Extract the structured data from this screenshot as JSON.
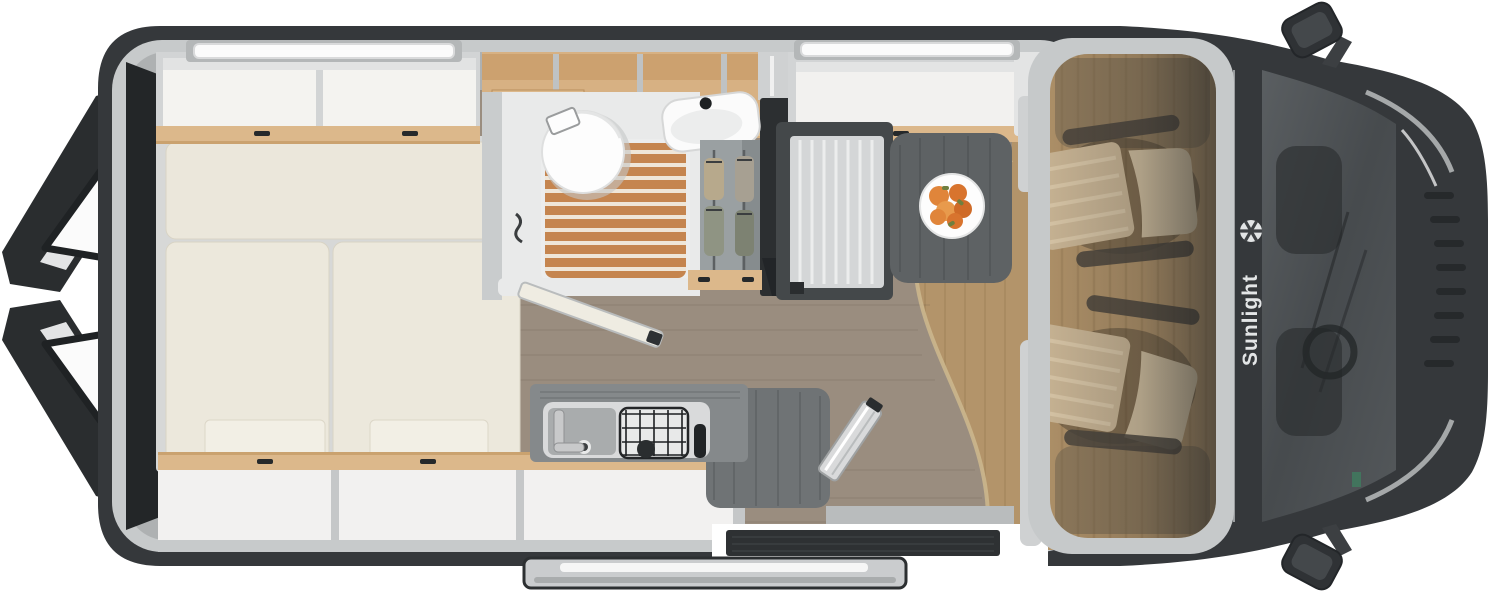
{
  "brand": {
    "name": "Sunlight",
    "logo_icon": "sun-logo-icon"
  },
  "scene": {
    "type": "campervan-floorplan-top-view",
    "areas": [
      "rear-doors-open",
      "rear-bed",
      "overhead-cabinets",
      "bathroom-toilet",
      "shower-grate",
      "washbasin",
      "wardrobe",
      "fridge",
      "kitchen-sink",
      "gas-hob",
      "worktop-extension",
      "dinette-bench",
      "dining-table",
      "fruit-plate",
      "entry-door-open",
      "sliding-door-panel",
      "cab-seats-swiveled",
      "windshield",
      "side-mirrors",
      "front-grille",
      "roof-skylights"
    ]
  },
  "palette": {
    "body_dark": "#35383b",
    "inner_wall": "#c7cacb",
    "wood_trim": "#dcb88b",
    "shelf_wood": "#d7b183",
    "cushion_cream": "#ece8dc",
    "floor_living": "#9a8d7f",
    "floor_cab": "#b3946a",
    "shower_wood": "#c5854f",
    "counter_gray": "#85898b",
    "table_gray": "#5e6264",
    "seat_tan": "#cdb897",
    "fruit_orange": "#e0853a",
    "switch_red": "#c0392b",
    "logo_white": "#e3e5e6"
  }
}
